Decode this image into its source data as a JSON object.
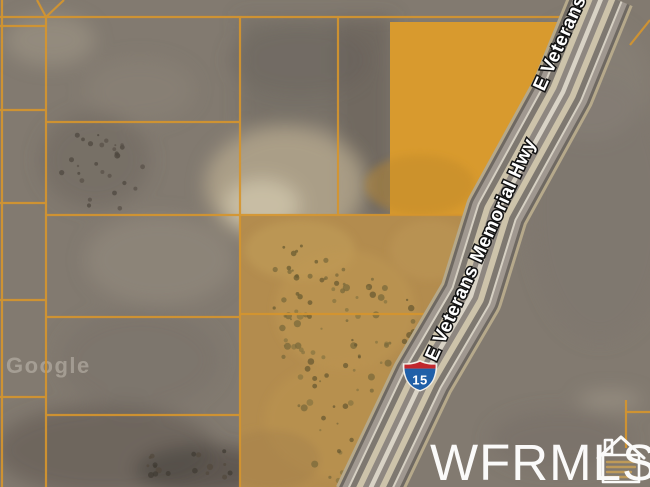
{
  "map": {
    "road_labels": {
      "primary": "E Veterans Memorial Hwy",
      "secondary": "E Veterans Memorial Hwy"
    },
    "interstate_shield": {
      "number": "15"
    },
    "watermarks": {
      "mls": "WFRMLS",
      "imagery": "Google"
    }
  },
  "colors": {
    "parcel_line": "#d5952e",
    "parcel_fill_bright": "#d89a2e",
    "parcel_fill_muted": "#b38c4e",
    "shield_blue": "#2060a8",
    "shield_red": "#c1272d",
    "road_label_text": "#ffffff",
    "watermark_text": "#ffffff"
  }
}
